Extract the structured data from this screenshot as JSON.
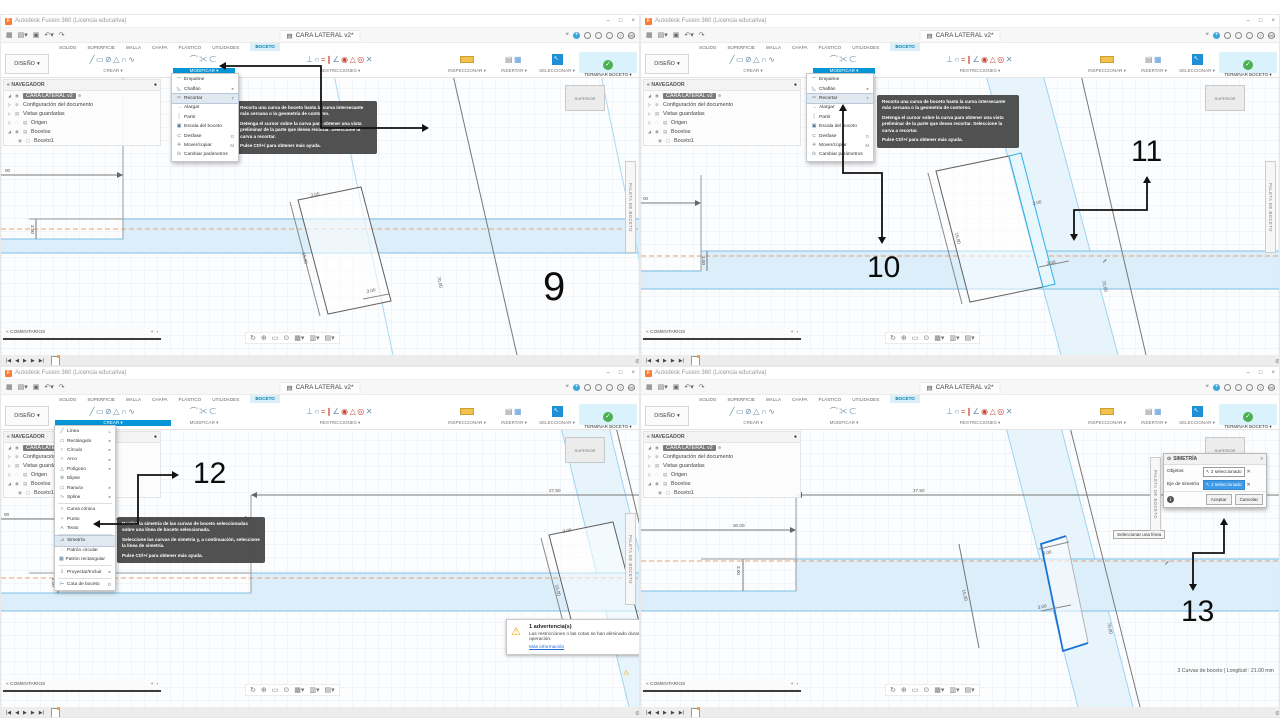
{
  "window": {
    "title": "Autodesk Fusion 360 (Licencia educativa)",
    "doc_tab": "CARA LATERAL v2*",
    "design_menu": "DISEÑO",
    "ribbon_tabs": [
      "SOLIDO",
      "SUPERFICIE",
      "MALLA",
      "CHAPA",
      "PLÁSTICO",
      "UTILIDADES"
    ],
    "sketch_tab": "BOCETO",
    "toolbar_groups": {
      "crear": "CREAR",
      "modificar": "MODIFICAR",
      "restricciones": "RESTRICCIONES",
      "inspeccionar": "INSPECCIONAR",
      "insertar": "INSERTAR",
      "seleccionar": "SELECCIONAR",
      "terminar_boceto": "TERMINAR BOCETO"
    },
    "navigator": {
      "title": "NAVEGADOR",
      "root": "CARA LATERAL v2",
      "item1": "Configuración del documento",
      "item2": "Vistas guardadas",
      "item3": "Origen",
      "item4": "Bocetos",
      "sketch": "Boceto1"
    },
    "comments_label": "COMENTARIOS",
    "palette_label": "PALETA DE BOCETO",
    "viewcube_label": "SUPERIOR",
    "avatar": "MC"
  },
  "menu_modificar": {
    "items": [
      {
        "label": "Empalme",
        "shortcut": ""
      },
      {
        "label": "Chaflán",
        "shortcut": "▸"
      },
      {
        "label": "Recortar",
        "shortcut": "T"
      },
      {
        "label": "Alargar",
        "shortcut": ""
      },
      {
        "label": "Partir",
        "shortcut": ""
      },
      {
        "label": "Escala del boceto",
        "shortcut": ""
      },
      {
        "label": "Desfase",
        "shortcut": "O"
      },
      {
        "label": "Mover/copiar",
        "shortcut": "M"
      },
      {
        "label": "Cambiar parámetros",
        "shortcut": ""
      }
    ]
  },
  "menu_crear": {
    "items": [
      {
        "label": "Línea",
        "shortcut": "L"
      },
      {
        "label": "Rectángulo",
        "shortcut": "▸"
      },
      {
        "label": "Círculo",
        "shortcut": "▸"
      },
      {
        "label": "Arco",
        "shortcut": "▸"
      },
      {
        "label": "Polígono",
        "shortcut": "▸"
      },
      {
        "label": "Elipse",
        "shortcut": ""
      },
      {
        "label": "Ranura",
        "shortcut": "▸"
      },
      {
        "label": "Spline",
        "shortcut": "▸"
      },
      {
        "label": "Curva cónica",
        "shortcut": ""
      },
      {
        "label": "Punto",
        "shortcut": ""
      },
      {
        "label": "Texto",
        "shortcut": ""
      },
      {
        "label": "Simetría",
        "shortcut": ""
      },
      {
        "label": "Patrón circular",
        "shortcut": ""
      },
      {
        "label": "Patrón rectangular",
        "shortcut": ""
      },
      {
        "label": "Proyectar/Incluir",
        "shortcut": "▸"
      },
      {
        "label": "Cota de boceto",
        "shortcut": "D"
      }
    ]
  },
  "tooltip_recortar": {
    "p1": "Recorta una curva de boceto hasta la curva intersecante más cercana o la geometría de contorno.",
    "p2": "Detenga el cursor sobre la curva para obtener una vista preliminar de la parte que desea recortar. Seleccione la curva a recortar.",
    "p3": "Pulse Ctrl+/ para obtener más ayuda."
  },
  "tooltip_simetria": {
    "p1": "Realiza la simetría de las curvas de boceto seleccionadas sobre una línea de boceto seleccionada.",
    "p2": "Seleccione las curvas de simetría y, a continuación, seleccione la línea de simetría.",
    "p3": "Pulse Ctrl+/ para obtener más ayuda."
  },
  "dialog_simetria": {
    "title": "SIMETRÍA",
    "objects_label": "Objetos",
    "objects_value": "2 seleccionado",
    "axis_label": "Eje de simetría",
    "axis_value": "1 seleccionado",
    "ok": "Aceptar",
    "cancel": "Cancelar",
    "hint": "Seleccionar una línea"
  },
  "warning_box": {
    "title": "1 advertencia(s)",
    "body": "Las restricciones o las cotas se han eliminado durante la operación.",
    "link": "Más información"
  },
  "status_right": "3 Curvas de boceto | Longitud : 21.00 mm",
  "dimensions": {
    "q1": {
      "d30": "00",
      "dstep": "3.00",
      "dtop": "3.00",
      "dleft": "15.00",
      "dbot": "3.00",
      "dlong": "70.00"
    },
    "q2": {
      "d30": "00",
      "dstep": "3.00",
      "dtop": "3.00",
      "dleft": "15.00",
      "dbot": "3.00",
      "dlong": "70.00"
    },
    "q3": {
      "d2750": "27.50",
      "d30": "00",
      "dstep": "3.00",
      "dtop": "3.00",
      "dleft": "15.00",
      "dlong": "70.00"
    },
    "q4": {
      "d2750": "27.50",
      "d30": "30.00",
      "dstep": "3.00",
      "dtop": "3.00",
      "dmid": "3.00",
      "dleft": "15.00",
      "dlong": "70.00"
    }
  },
  "annotations": {
    "step9": "9",
    "step10": "10",
    "step11": "11",
    "step12": "12",
    "step13": "13"
  }
}
